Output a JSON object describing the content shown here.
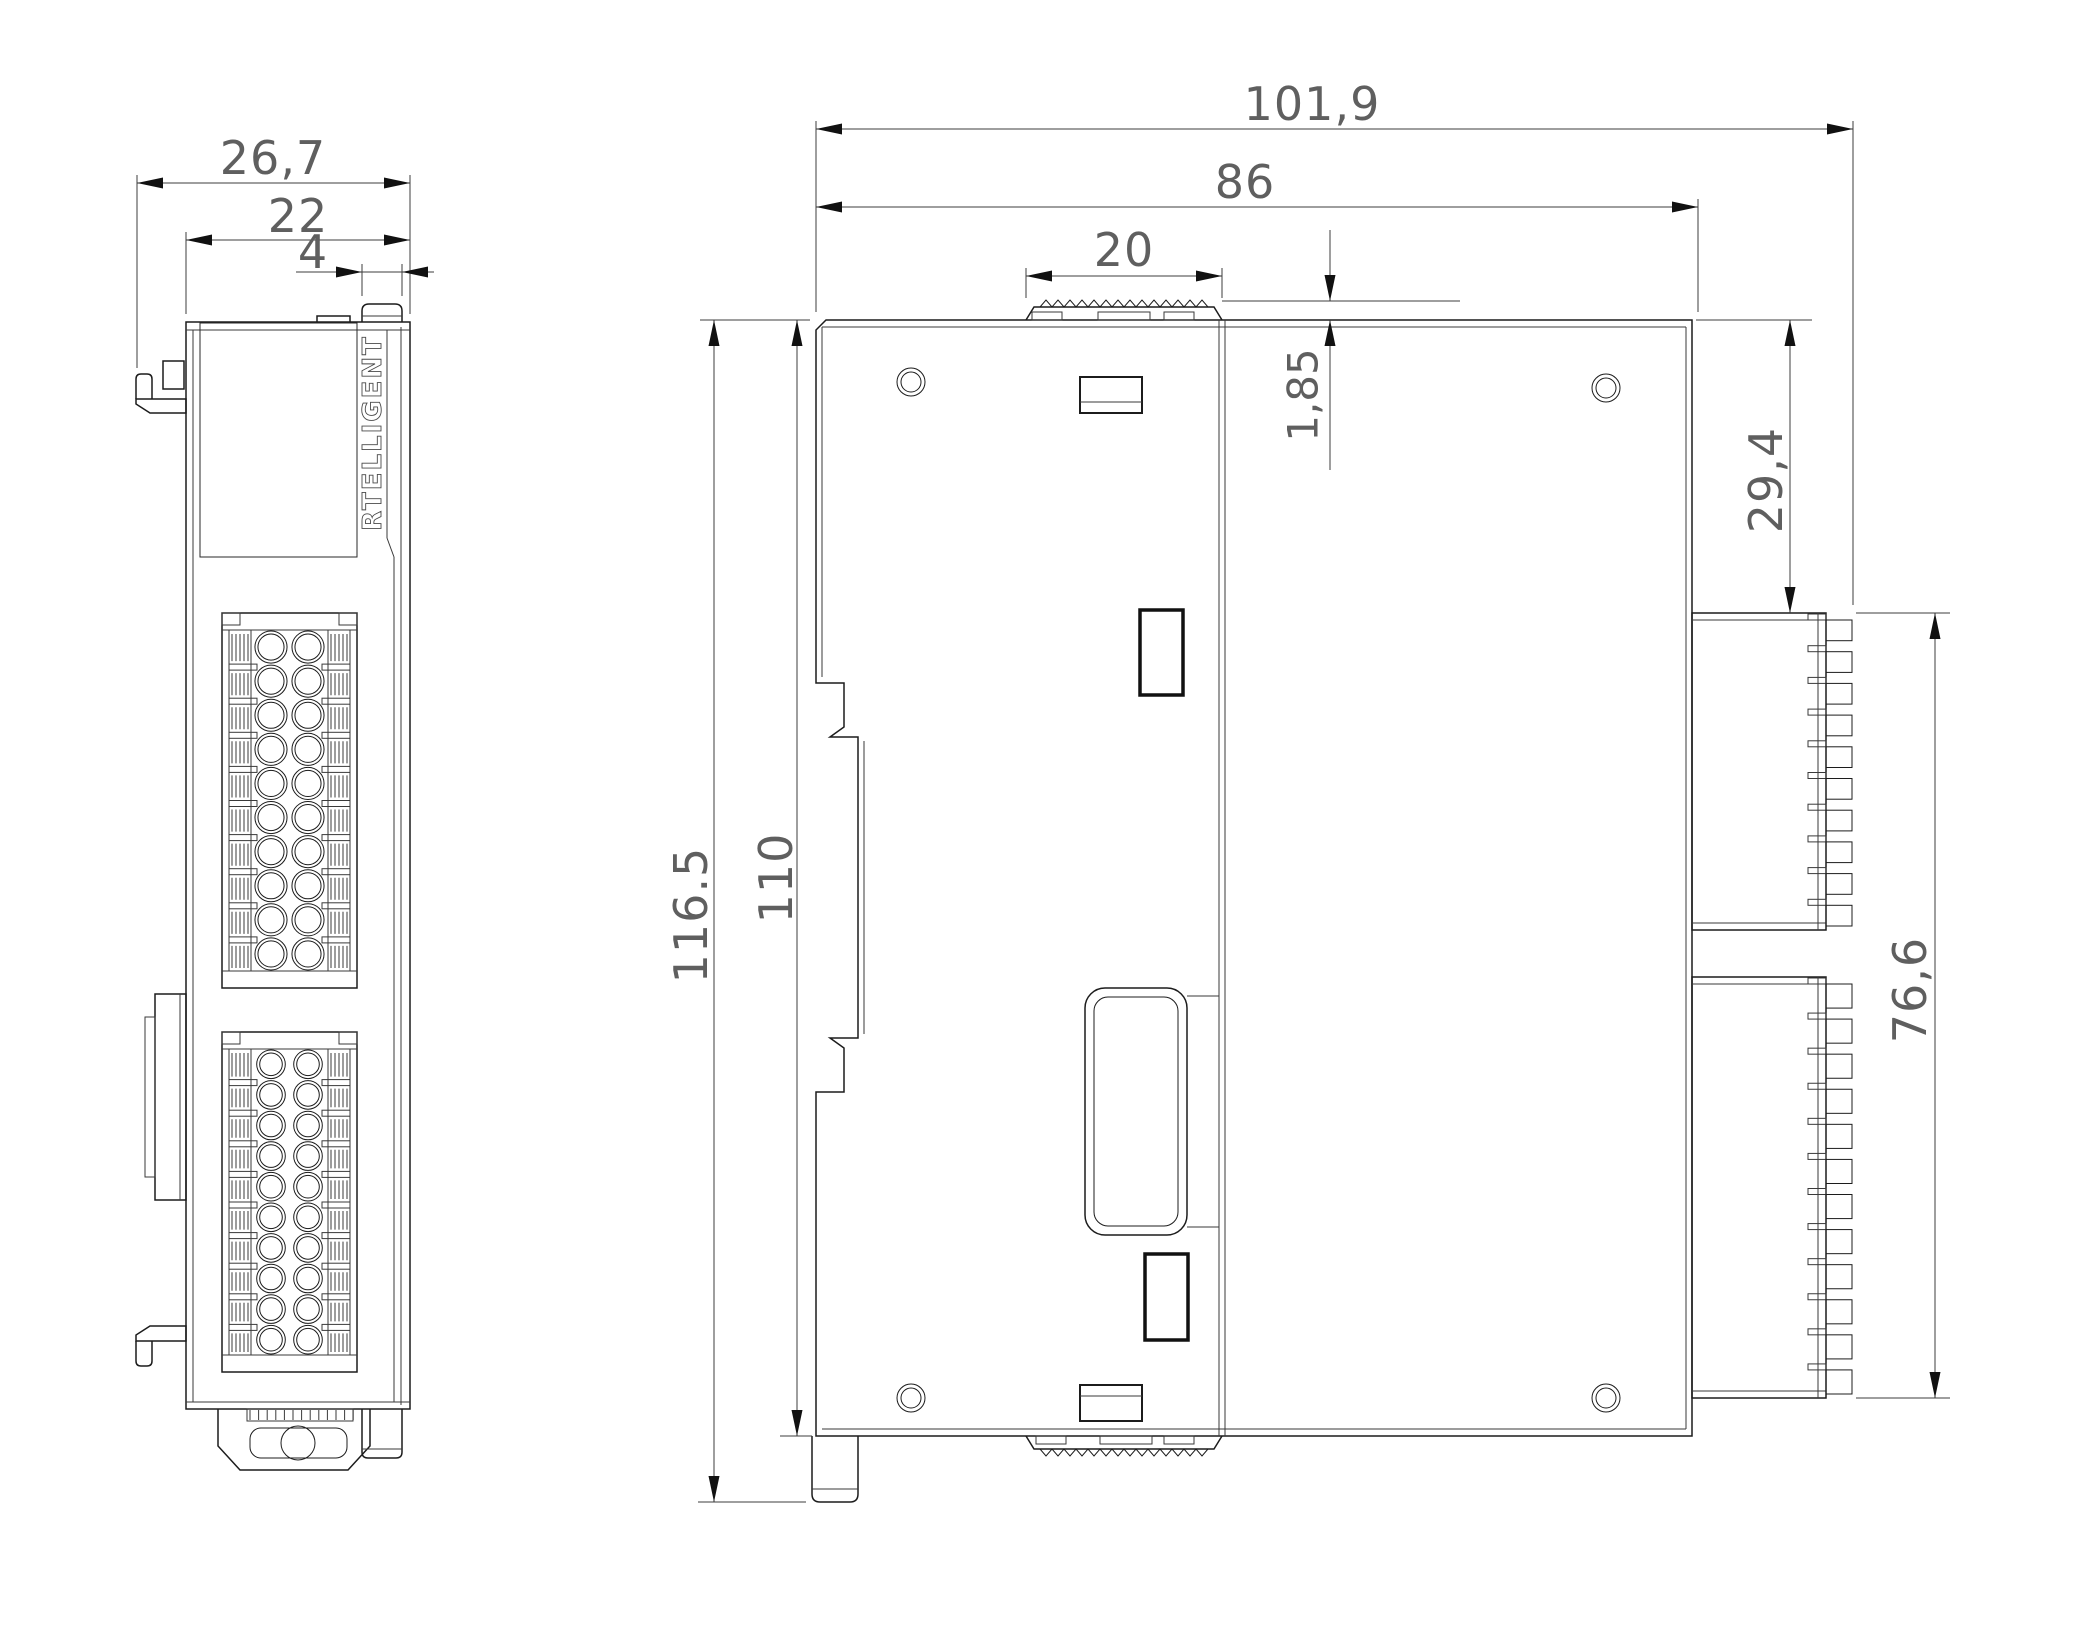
{
  "drawing_type": "technical-dimension-drawing",
  "brand": {
    "logo_text": "RTELLIGENT"
  },
  "dimensions": {
    "front_total_width": "26,7",
    "front_body_width": "22",
    "front_button_width": "4",
    "side_total_depth": "101,9",
    "side_body_depth": "86",
    "din_slider_width": "20",
    "slider_protrusion": "1,85",
    "connector_top_offset": "29,4",
    "connectors_span": "76,6",
    "total_height": "116.5",
    "body_height": "110"
  },
  "colors": {
    "line": "#1c1c1c",
    "dim_text": "#5f5f5f",
    "background": "#ffffff"
  },
  "geometry": {
    "front_blocks": [
      {
        "x": 222,
        "y": 613,
        "w": 135,
        "h": 375
      },
      {
        "x": 222,
        "y": 1032,
        "w": 135,
        "h": 340
      }
    ],
    "front_block_rows": 10,
    "front_circle_cols": [
      49,
      86
    ],
    "side_connectors": [
      {
        "y": 613,
        "h": 317,
        "n": 10
      },
      {
        "y": 977,
        "h": 421,
        "n": 12
      }
    ],
    "top_zigzag": {
      "x": 1040,
      "n": 14,
      "base": 307,
      "peak": 300
    },
    "bottom_zigzag": {
      "x": 1040,
      "n": 14,
      "base": 1449,
      "peak": 1456
    },
    "serr_ticks": {
      "x": 250,
      "n": 13,
      "step": 8.6,
      "y1": 1410,
      "y2": 1420
    },
    "arrows": [
      [
        137,
        183,
        "L"
      ],
      [
        410,
        183,
        "R"
      ],
      [
        186,
        240,
        "L"
      ],
      [
        410,
        240,
        "R"
      ],
      [
        362,
        272,
        "R"
      ],
      [
        402,
        272,
        "L"
      ],
      [
        816,
        129,
        "L"
      ],
      [
        1853,
        129,
        "R"
      ],
      [
        816,
        207,
        "L"
      ],
      [
        1698,
        207,
        "R"
      ],
      [
        1026,
        276,
        "L"
      ],
      [
        1222,
        276,
        "R"
      ],
      [
        1330,
        301,
        "D"
      ],
      [
        1330,
        320,
        "U"
      ],
      [
        1790,
        320,
        "U"
      ],
      [
        1790,
        613,
        "D"
      ],
      [
        1935,
        613,
        "U"
      ],
      [
        1935,
        1398,
        "D"
      ],
      [
        714,
        320,
        "U"
      ],
      [
        714,
        1502,
        "D"
      ],
      [
        797,
        320,
        "U"
      ],
      [
        797,
        1436,
        "D"
      ]
    ]
  }
}
